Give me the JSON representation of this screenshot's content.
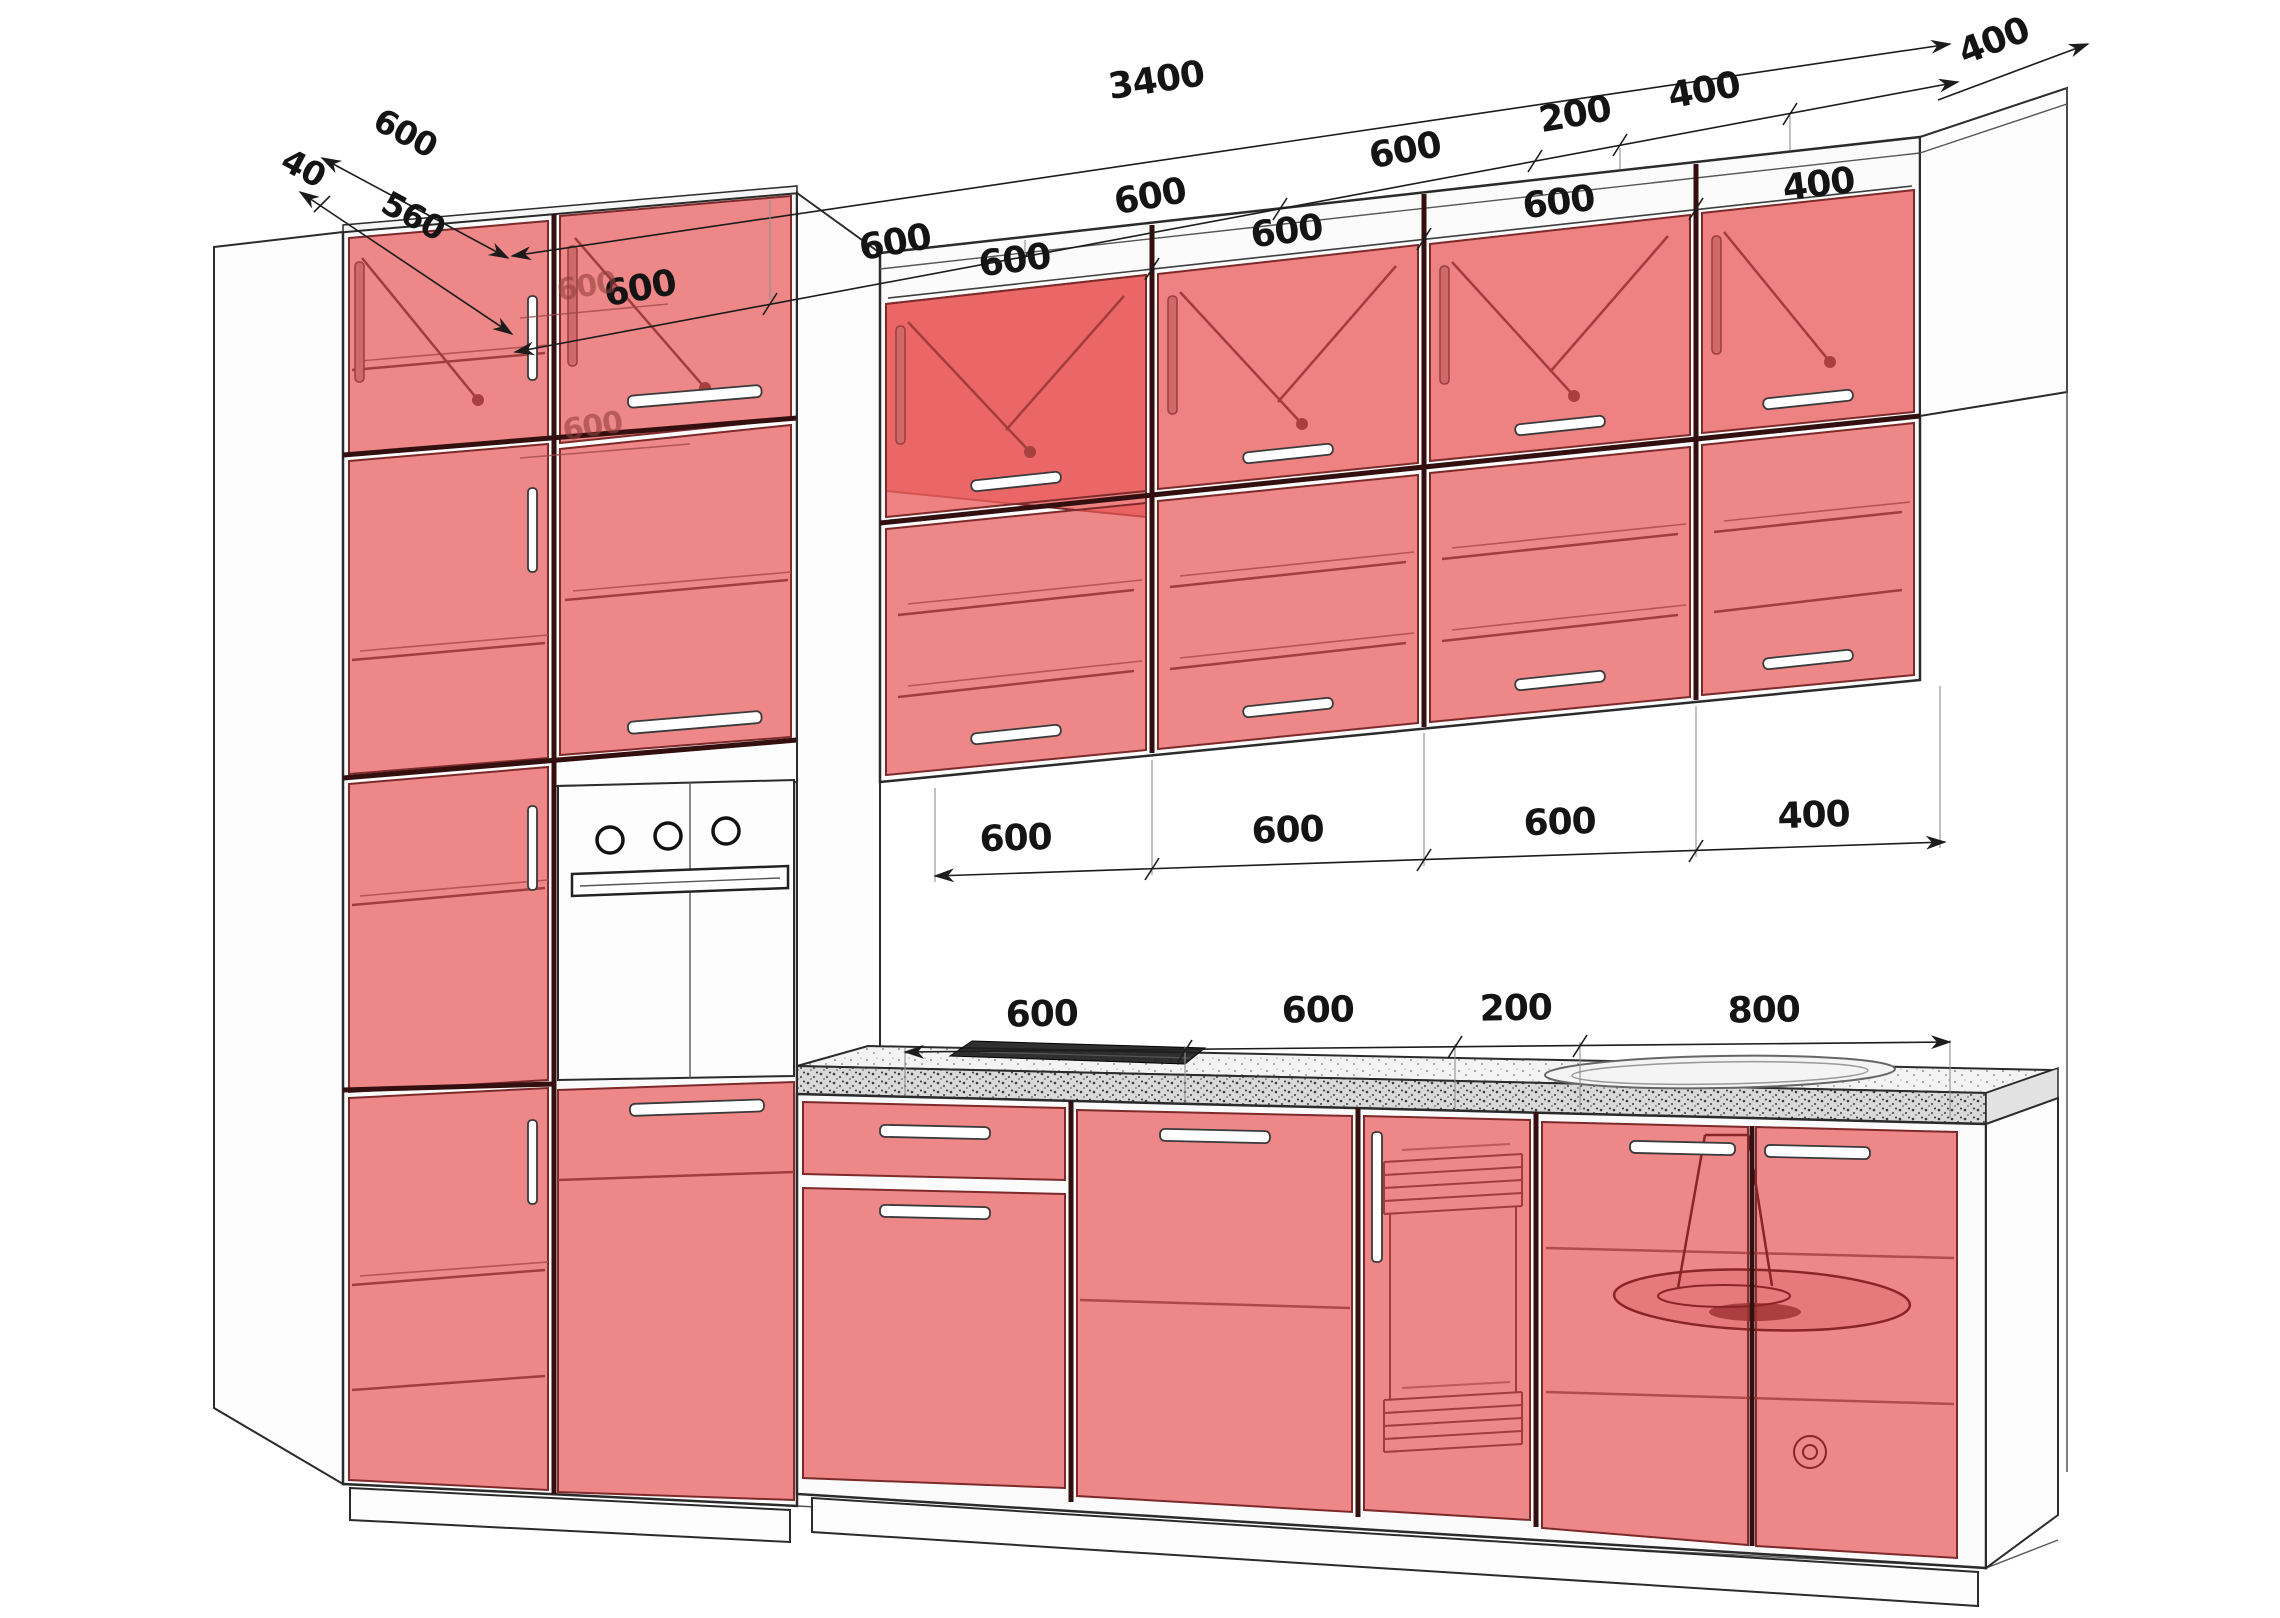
{
  "meta": {
    "drawing": "kitchen-cabinet-elevation",
    "units": "mm",
    "style": "3d-perspective-wireframe"
  },
  "colors": {
    "cabinet_front": "#ee8080",
    "cabinet_front_fill": "#e85656",
    "front_outline": "#7e2a2a",
    "interior_lines": "#a33d3d",
    "carcass_edge": "#2b2b2b",
    "dimension_lines": "#1c1c1c",
    "countertop": "#e9e9e9",
    "background": "#ffffff"
  },
  "dimensions": {
    "total": "3400",
    "depth": {
      "overall": "600",
      "front_gap": "40",
      "carcass": "560"
    },
    "top_chain": [
      "600",
      "600",
      "600",
      "600",
      "200",
      "400"
    ],
    "corner_depth": "400",
    "upper_cabinets": [
      "600",
      "600",
      "600",
      "400"
    ],
    "tall_unit_inner": [
      "600",
      "600"
    ],
    "wall_bottom_chain": [
      "600",
      "600",
      "600",
      "400"
    ],
    "base_chain": [
      "600",
      "600",
      "200",
      "800"
    ]
  },
  "icons": {
    "oven": "built-in-oven-icon",
    "hob": "cooktop-icon",
    "sink": "sink-bowl-icon",
    "faucet": "faucet-icon",
    "cargo": "pullout-wire-basket-icon"
  }
}
